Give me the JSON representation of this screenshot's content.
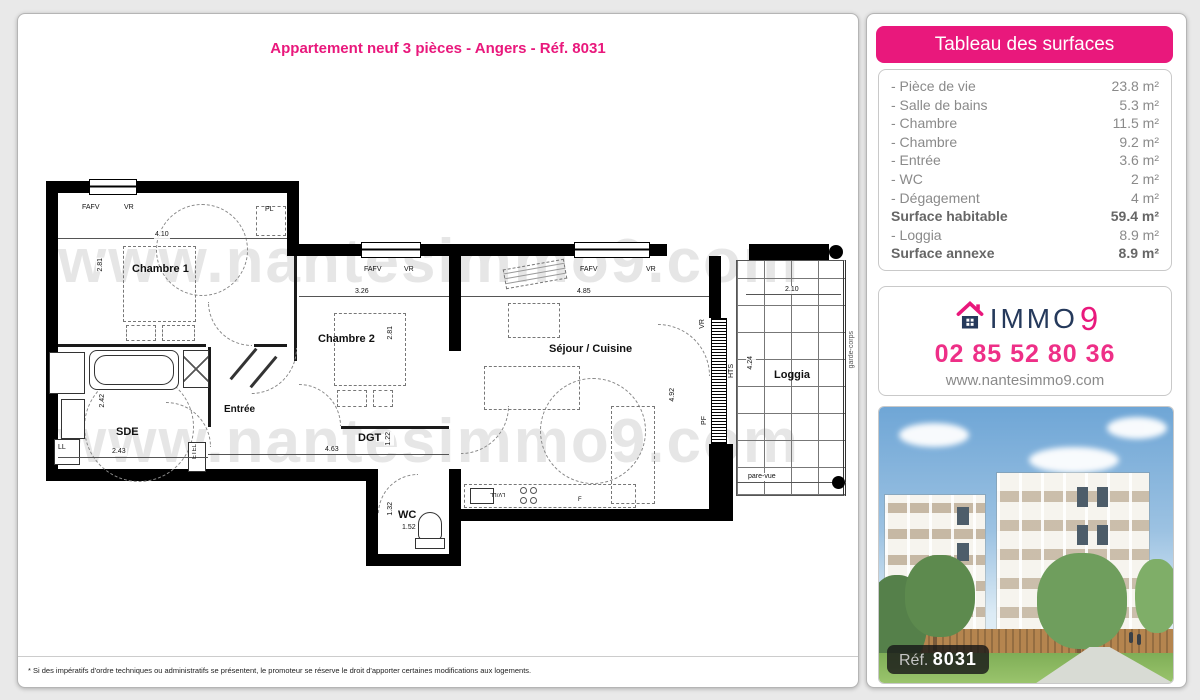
{
  "page": {
    "title": "Appartement neuf 3 pièces - Angers - Réf. 8031",
    "footnote": "* Si des impératifs d'ordre techniques ou administratifs se présentent, le promoteur se réserve le droit d'apporter certaines modifications aux logements."
  },
  "watermark": "www.nantesimmo9.com",
  "surfaces": {
    "header": "Tableau des surfaces",
    "rows": [
      {
        "label": "- Pièce de vie",
        "value": "23.8 m²"
      },
      {
        "label": "- Salle de bains",
        "value": "5.3 m²"
      },
      {
        "label": "- Chambre",
        "value": "11.5 m²"
      },
      {
        "label": "- Chambre",
        "value": "9.2 m²"
      },
      {
        "label": "- Entrée",
        "value": "3.6 m²"
      },
      {
        "label": "- WC",
        "value": "2 m²"
      },
      {
        "label": "- Dégagement",
        "value": "4 m²"
      },
      {
        "label": "Surface habitable",
        "value": "59.4 m²"
      },
      {
        "label": "- Loggia",
        "value": "8.9 m²"
      },
      {
        "label": "Surface annexe",
        "value": "8.9 m²"
      }
    ]
  },
  "contact": {
    "brand_immo": "IMMO",
    "brand_9": "9",
    "phone": "02 85 52 80 36",
    "website": "www.nantesimmo9.com"
  },
  "photo": {
    "ref_label": "Réf.",
    "ref_number": "8031"
  },
  "plan": {
    "rooms": {
      "chambre1": "Chambre 1",
      "chambre2": "Chambre 2",
      "sejour": "Séjour / Cuisine",
      "entree": "Entrée",
      "sde": "SDE",
      "dgt": "DGT",
      "wc": "WC",
      "loggia": "Loggia"
    },
    "dims": {
      "c1w": "4.10",
      "c1h": "2.81",
      "c2w": "3.26",
      "c2h": "2.81",
      "sjw": "4.85",
      "sjh": "4.92",
      "sdew": "2.43",
      "sdeh": "2.42",
      "dgtw": "4.63",
      "dgth": "1.22",
      "wcw": "1.52",
      "wch": "1.32",
      "logw": "2.10",
      "logh": "4.24"
    },
    "labels": {
      "fafv": "FAFV",
      "vr": "VR",
      "pl": "PL",
      "ll": "LL",
      "etel": "ETEL",
      "hts": "HTS",
      "pf": "PF",
      "lvll": "LV/LL",
      "f": "F",
      "garde": "garde-corps",
      "pare": "pare-vue"
    }
  },
  "colors": {
    "accent": "#e9187c",
    "navy": "#25395b"
  }
}
